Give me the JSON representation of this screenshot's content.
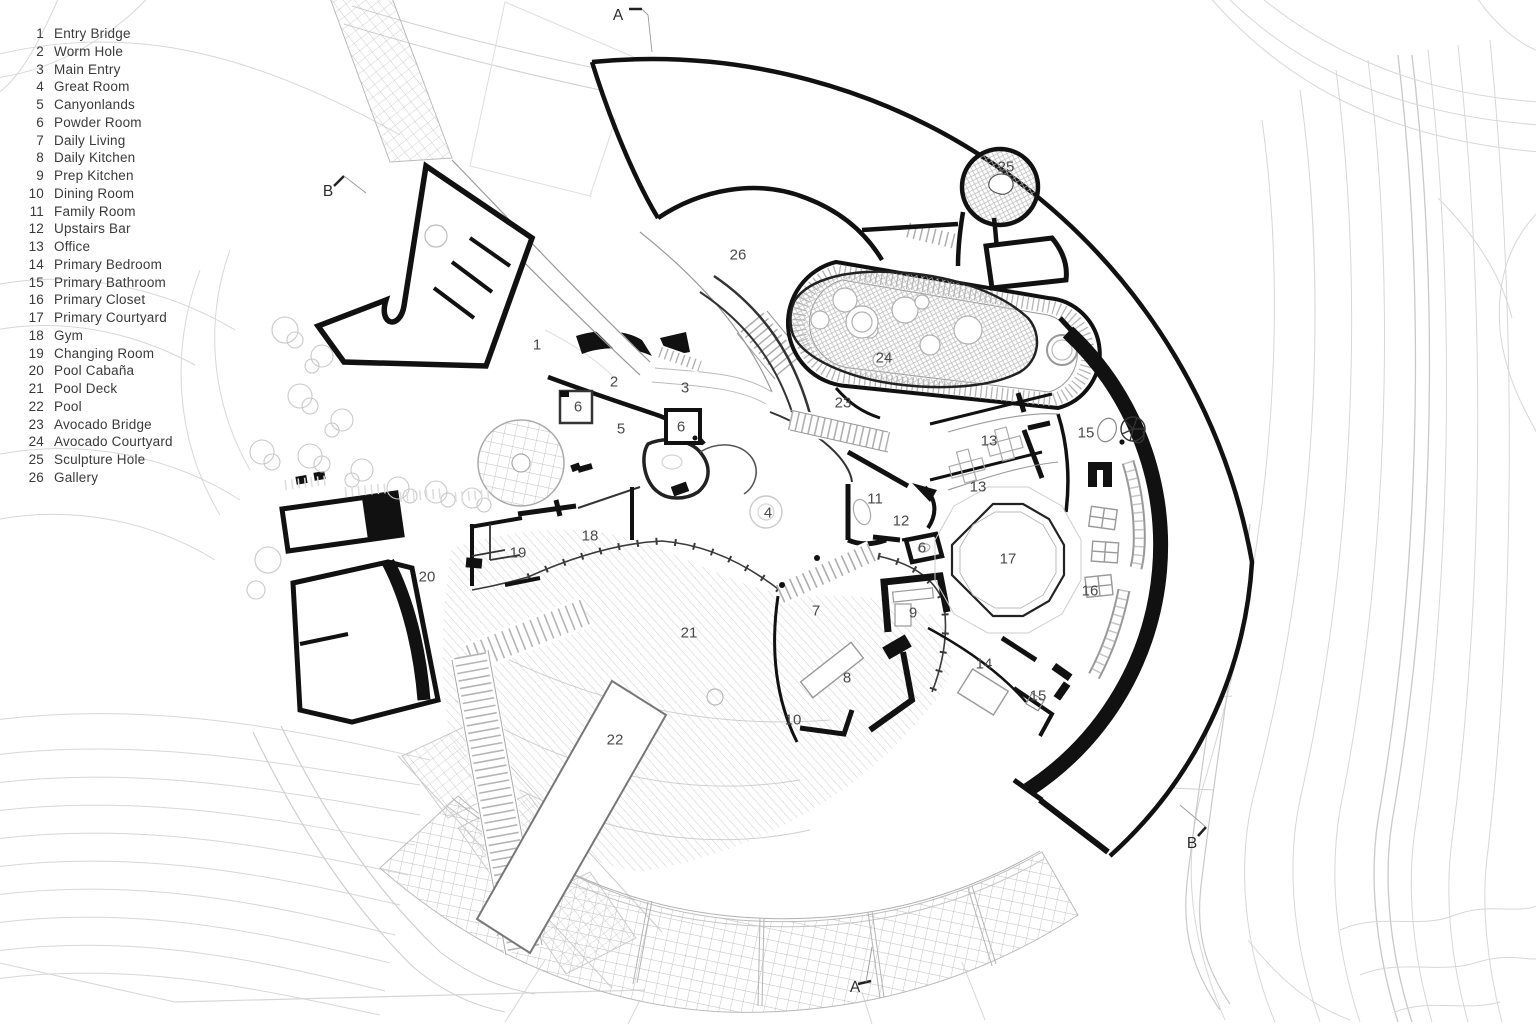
{
  "legend": {
    "items": [
      {
        "num": "1",
        "label": "Entry Bridge"
      },
      {
        "num": "2",
        "label": "Worm Hole"
      },
      {
        "num": "3",
        "label": "Main Entry"
      },
      {
        "num": "4",
        "label": "Great Room"
      },
      {
        "num": "5",
        "label": "Canyonlands"
      },
      {
        "num": "6",
        "label": "Powder Room"
      },
      {
        "num": "7",
        "label": "Daily Living"
      },
      {
        "num": "8",
        "label": "Daily Kitchen"
      },
      {
        "num": "9",
        "label": "Prep Kitchen"
      },
      {
        "num": "10",
        "label": "Dining Room"
      },
      {
        "num": "11",
        "label": "Family Room"
      },
      {
        "num": "12",
        "label": "Upstairs Bar"
      },
      {
        "num": "13",
        "label": "Office"
      },
      {
        "num": "14",
        "label": "Primary Bedroom"
      },
      {
        "num": "15",
        "label": "Primary Bathroom"
      },
      {
        "num": "16",
        "label": "Primary Closet"
      },
      {
        "num": "17",
        "label": "Primary Courtyard"
      },
      {
        "num": "18",
        "label": "Gym"
      },
      {
        "num": "19",
        "label": "Changing Room"
      },
      {
        "num": "20",
        "label": "Pool Cabaña"
      },
      {
        "num": "21",
        "label": "Pool Deck"
      },
      {
        "num": "22",
        "label": "Pool"
      },
      {
        "num": "23",
        "label": "Avocado Bridge"
      },
      {
        "num": "24",
        "label": "Avocado Courtyard"
      },
      {
        "num": "25",
        "label": "Sculpture Hole"
      },
      {
        "num": "26",
        "label": "Gallery"
      }
    ]
  },
  "plan": {
    "labels": [
      {
        "text": "1",
        "room": "Entry Bridge",
        "x": 537,
        "y": 345
      },
      {
        "text": "2",
        "room": "Worm Hole",
        "x": 614,
        "y": 382
      },
      {
        "text": "3",
        "room": "Main Entry",
        "x": 685,
        "y": 388
      },
      {
        "text": "6",
        "room": "Powder Room",
        "x": 578,
        "y": 407
      },
      {
        "text": "5",
        "room": "Canyonlands",
        "x": 621,
        "y": 429
      },
      {
        "text": "6",
        "room": "Powder Room",
        "x": 681,
        "y": 427
      },
      {
        "text": "4",
        "room": "Great Room",
        "x": 768,
        "y": 513
      },
      {
        "text": "26",
        "room": "Gallery",
        "x": 738,
        "y": 255
      },
      {
        "text": "25",
        "room": "Sculpture Hole",
        "x": 1006,
        "y": 167
      },
      {
        "text": "24",
        "room": "Avocado Courtyard",
        "x": 884,
        "y": 358
      },
      {
        "text": "23",
        "room": "Avocado Bridge",
        "x": 843,
        "y": 403
      },
      {
        "text": "13",
        "room": "Office",
        "x": 989,
        "y": 441
      },
      {
        "text": "15",
        "room": "Primary Bathroom",
        "x": 1086,
        "y": 433
      },
      {
        "text": "13",
        "room": "Office",
        "x": 978,
        "y": 487
      },
      {
        "text": "11",
        "room": "Family Room",
        "x": 875,
        "y": 499
      },
      {
        "text": "12",
        "room": "Upstairs Bar",
        "x": 901,
        "y": 521
      },
      {
        "text": "6",
        "room": "Powder Room",
        "x": 922,
        "y": 548
      },
      {
        "text": "17",
        "room": "Primary Courtyard",
        "x": 1008,
        "y": 559
      },
      {
        "text": "16",
        "room": "Primary Closet",
        "x": 1090,
        "y": 591
      },
      {
        "text": "18",
        "room": "Gym",
        "x": 590,
        "y": 536
      },
      {
        "text": "19",
        "room": "Changing Room",
        "x": 518,
        "y": 553
      },
      {
        "text": "20",
        "room": "Pool Cabaña",
        "x": 427,
        "y": 577
      },
      {
        "text": "7",
        "room": "Daily Living",
        "x": 816,
        "y": 611
      },
      {
        "text": "9",
        "room": "Prep Kitchen",
        "x": 913,
        "y": 613
      },
      {
        "text": "8",
        "room": "Daily Kitchen",
        "x": 847,
        "y": 678
      },
      {
        "text": "14",
        "room": "Primary Bedroom",
        "x": 984,
        "y": 664
      },
      {
        "text": "15",
        "room": "Primary Bathroom",
        "x": 1038,
        "y": 696
      },
      {
        "text": "21",
        "room": "Pool Deck",
        "x": 689,
        "y": 633
      },
      {
        "text": "22",
        "room": "Pool",
        "x": 615,
        "y": 740
      },
      {
        "text": "10",
        "room": "Dining Room",
        "x": 793,
        "y": 720
      }
    ],
    "section_markers": [
      {
        "text": "A",
        "x": 618,
        "y": 16
      },
      {
        "text": "A",
        "x": 855,
        "y": 988
      },
      {
        "text": "B",
        "x": 328,
        "y": 192
      },
      {
        "text": "B",
        "x": 1192,
        "y": 844
      }
    ]
  },
  "colors": {
    "ink": "#141414",
    "wall": "#111111",
    "contour": "#d7d7d7",
    "hatch": "#bdbdbd",
    "label": "#4a4a4a",
    "background": "#ffffff"
  }
}
